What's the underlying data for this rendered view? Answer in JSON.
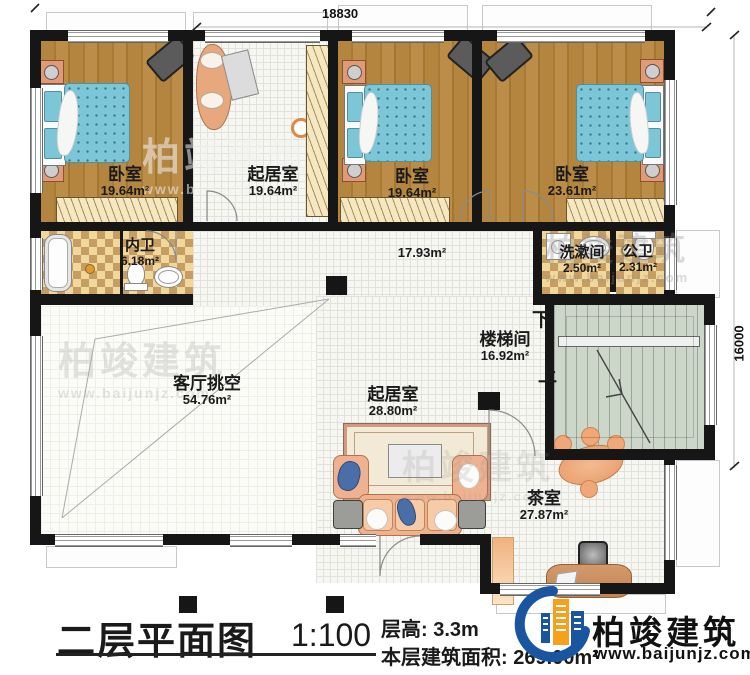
{
  "plan": {
    "dim_top": "18830",
    "dim_right": "16000",
    "rooms": {
      "bedroom1": {
        "name": "卧室",
        "area": "19.64m²"
      },
      "study": {
        "name": "起居室",
        "area": "19.64m²"
      },
      "bedroom2": {
        "name": "卧室",
        "area": "19.64m²"
      },
      "bedroom3": {
        "name": "卧室",
        "area": "23.61m²"
      },
      "bath_inner": {
        "name": "内卫",
        "area": "6.18m²"
      },
      "hall": {
        "area": "17.93m²"
      },
      "wash": {
        "name": "洗漱间",
        "area": "2.50m²"
      },
      "bath_public": {
        "name": "公卫",
        "area": "2.31m²"
      },
      "stairwell": {
        "name": "楼梯间",
        "area": "16.92m²"
      },
      "void": {
        "name": "客厅挑空",
        "area": "54.76m²"
      },
      "living2": {
        "name": "起居室",
        "area": "28.80m²"
      },
      "tea": {
        "name": "茶室",
        "area": "27.87m²"
      }
    },
    "stair_marks": {
      "down": "下",
      "up": "上"
    }
  },
  "title_block": {
    "title": "二层平面图",
    "scale": "1:100",
    "floor_height": "层高: 3.3m",
    "floor_area": "本层建筑面积: 269.00m²"
  },
  "brand": {
    "name": "柏竣建筑",
    "url": "www.baijunjz.com"
  },
  "watermark": {
    "name": "柏竣建筑",
    "url": "www.baijunjz.com"
  },
  "colors": {
    "brand_blue": "#1a56a0",
    "brand_orange": "#f6a01c",
    "wood": "#b3853f",
    "stair_green": "#ccd7ca"
  }
}
